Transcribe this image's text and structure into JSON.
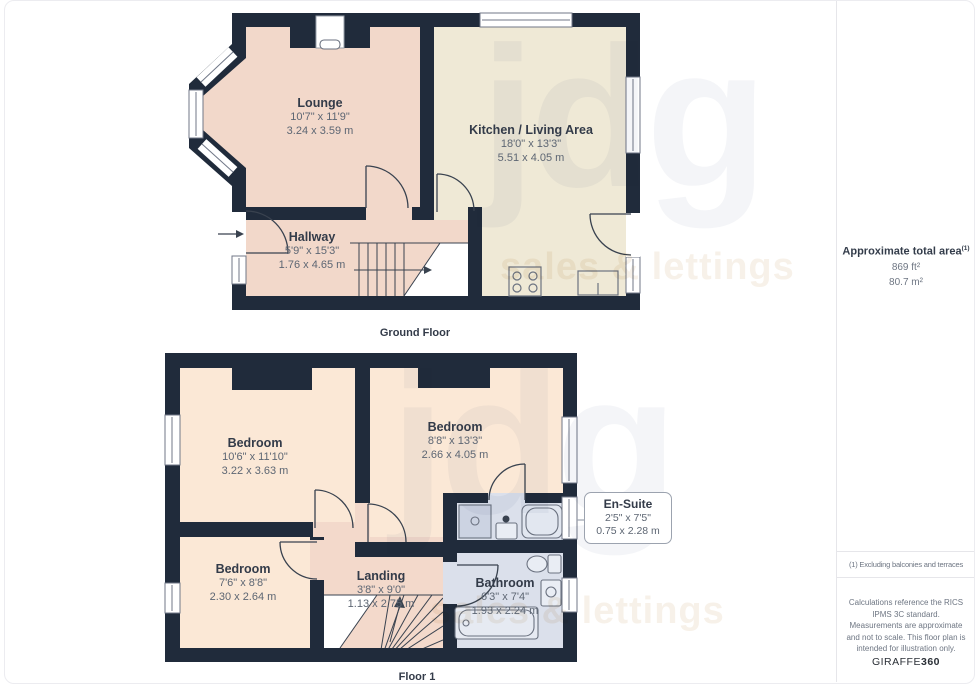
{
  "watermark": {
    "logo": "jdg",
    "tagline": "sales & lettings"
  },
  "floors": [
    {
      "caption": "Ground Floor",
      "rooms": [
        {
          "name": "Lounge",
          "imperial": "10'7\" x 11'9\"",
          "metric": "3.24 x 3.59 m"
        },
        {
          "name": "Kitchen / Living Area",
          "imperial": "18'0\" x 13'3\"",
          "metric": "5.51 x 4.05 m"
        },
        {
          "name": "Hallway",
          "imperial": "5'9\" x 15'3\"",
          "metric": "1.76 x 4.65 m"
        }
      ]
    },
    {
      "caption": "Floor 1",
      "rooms": [
        {
          "name": "Bedroom",
          "imperial": "10'6\" x 11'10\"",
          "metric": "3.22 x 3.63 m"
        },
        {
          "name": "Bedroom",
          "imperial": "8'8\" x 13'3\"",
          "metric": "2.66 x 4.05 m"
        },
        {
          "name": "Bedroom",
          "imperial": "7'6\" x 8'8\"",
          "metric": "2.30 x 2.64 m"
        },
        {
          "name": "Landing",
          "imperial": "3'8\" x 9'0\"",
          "metric": "1.13 x 2.75 m"
        },
        {
          "name": "Bathroom",
          "imperial": "6'3\" x 7'4\"",
          "metric": "1.93 x 2.24 m"
        }
      ]
    }
  ],
  "callout": {
    "name": "En-Suite",
    "imperial": "2'5\" x 7'5\"",
    "metric": "0.75 x 2.28 m"
  },
  "sidebar": {
    "total_area_label": "Approximate total area",
    "total_area_superscript": "(1)",
    "area_ft": "869 ft²",
    "area_m": "80.7 m²",
    "note": "(1) Excluding balconies and terraces",
    "disclaimer": "Calculations reference the RICS IPMS 3C standard. Measurements are approximate and not to scale. This floor plan is intended for illustration only.",
    "brand_normal": "GIRAFFE",
    "brand_bold": "360"
  },
  "colors": {
    "wall": "#202b3b",
    "lounge": "#f2d8ca",
    "kitchen": "#efe9d6",
    "hallway": "#f2d8ca",
    "bedroom": "#fbe8d6",
    "landing": "#f3d9cb",
    "bathroom": "#dbe0eb",
    "ensuite": "#dbe0eb"
  }
}
